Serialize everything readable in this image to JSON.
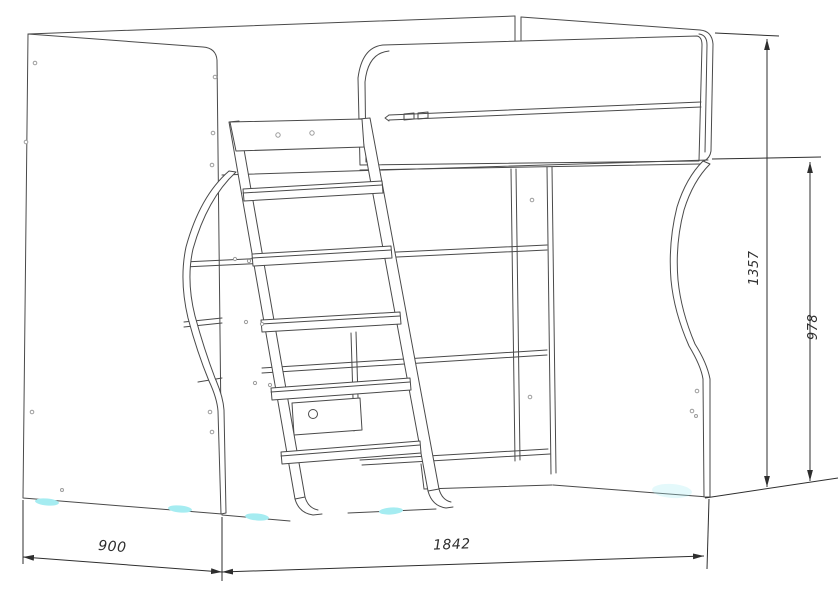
{
  "diagram": {
    "type": "technical-line-drawing",
    "subject": "loft bed with ladder, shelving unit and curved side supports",
    "dimensions": {
      "depth": {
        "value": "900"
      },
      "length": {
        "value": "1842"
      },
      "overall_height": {
        "value": "1357"
      },
      "side_height": {
        "value": "978"
      }
    },
    "colors": {
      "structure_line": "#4a4a4a",
      "dimension_line": "#2e2e2e",
      "hole_marks": "#9c9c9c",
      "foot_pad_accent": "#a5ecf1",
      "background": "#ffffff"
    }
  }
}
